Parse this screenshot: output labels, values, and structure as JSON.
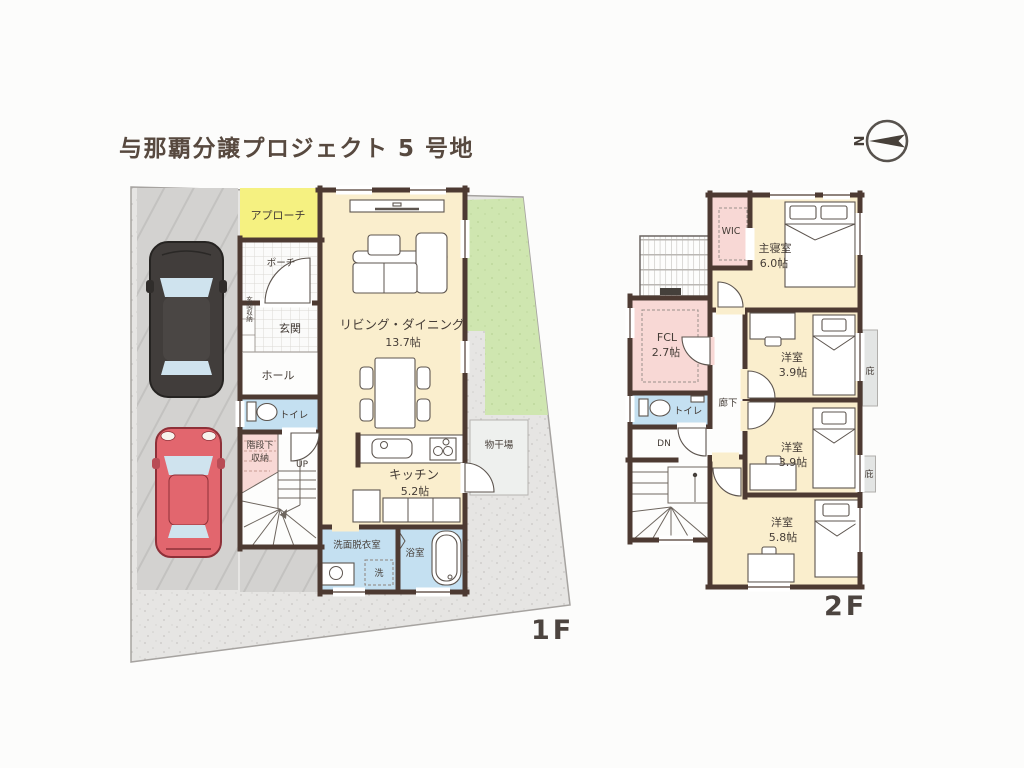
{
  "title": "与那覇分譲プロジェクト 5 号地",
  "compass": {
    "north_label": "N"
  },
  "colors": {
    "wall": "#4d3a32",
    "room_cream": "#faeecd",
    "closet_pink": "#f8d8d5",
    "wet_blue": "#c4e0f1",
    "approach_yellow": "#f5f181",
    "garden_green": "#cfe6b0",
    "parking_gray": "#d3d2d0",
    "gravel_gray": "#e6e5e3",
    "car_black": "#413d3b",
    "car_red": "#e2666e",
    "text": "#453d37"
  },
  "floor1": {
    "floor_label": "1F",
    "rooms": {
      "approach": "アプローチ",
      "porch": "ポーチ",
      "entrance_storage": "玄関収納",
      "entrance": "玄関",
      "hall": "ホール",
      "toilet": "トイレ",
      "stair_storage_line1": "階段下",
      "stair_storage_line2": "収納",
      "up": "UP",
      "living_dining": "リビング・ダイニング",
      "living_dining_size": "13.7帖",
      "kitchen": "キッチン",
      "kitchen_size": "5.2帖",
      "washroom": "洗面脱衣室",
      "washer": "洗",
      "bathroom": "浴室",
      "drying_area": "物干場"
    }
  },
  "floor2": {
    "floor_label": "2F",
    "rooms": {
      "wic": "WIC",
      "master_bedroom": "主寝室",
      "master_bedroom_size": "6.0帖",
      "fcl": "FCL",
      "fcl_size": "2.7帖",
      "toilet": "トイレ",
      "corridor": "廊下",
      "dn": "DN",
      "bedroom_a": "洋室",
      "bedroom_a_size": "3.9帖",
      "bedroom_b": "洋室",
      "bedroom_b_size": "3.9帖",
      "bedroom_c": "洋室",
      "bedroom_c_size": "5.8帖",
      "eaves_1": "庇",
      "eaves_2": "庇"
    }
  }
}
